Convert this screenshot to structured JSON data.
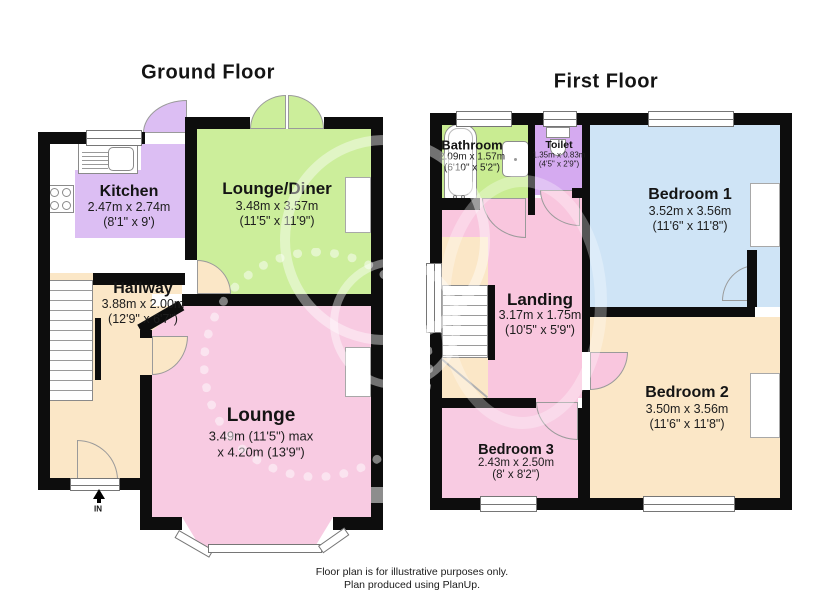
{
  "ground": {
    "title": "Ground Floor",
    "entrance_label": "IN",
    "rooms": {
      "kitchen": {
        "name": "Kitchen",
        "metric": "2.47m x 2.74m",
        "imperial": "(8'1\" x 9')"
      },
      "lounge_diner": {
        "name": "Lounge/Diner",
        "metric": "3.48m x 3.57m",
        "imperial": "(11'5\" x 11'9\")"
      },
      "hallway": {
        "name": "Hallway",
        "metric": "3.88m x 2.00m",
        "imperial": "(12'9\" x 6'7\")"
      },
      "lounge": {
        "name": "Lounge",
        "metric": "3.49m (11'5\") max",
        "imperial": "x 4.20m (13'9\")"
      }
    }
  },
  "first": {
    "title": "First Floor",
    "rooms": {
      "bathroom": {
        "name": "Bathroom",
        "metric": "2.09m x 1.57m",
        "imperial": "(6'10\" x 5'2\")"
      },
      "toilet": {
        "name": "Toilet",
        "metric": "1.35m x 0.83m",
        "imperial": "(4'5\" x 2'9\")"
      },
      "bedroom1": {
        "name": "Bedroom 1",
        "metric": "3.52m x 3.56m",
        "imperial": "(11'6\" x 11'8\")"
      },
      "landing": {
        "name": "Landing",
        "metric": "3.17m x 1.75m",
        "imperial": "(10'5\" x 5'9\")"
      },
      "bedroom2": {
        "name": "Bedroom 2",
        "metric": "3.50m x 3.56m",
        "imperial": "(11'6\" x 11'8\")"
      },
      "bedroom3": {
        "name": "Bedroom 3",
        "metric": "2.43m x 2.50m",
        "imperial": "(8' x 8'2\")"
      }
    }
  },
  "footer": {
    "line1": "Floor plan is for illustrative purposes only.",
    "line2": "Plan produced using PlanUp."
  },
  "colors": {
    "wall": "#0d0d0d",
    "kitchen": "#dcbef3",
    "lounge_diner": "#ccee9b",
    "hallway": "#fbe7c7",
    "lounge": "#f8cbe2",
    "bathroom": "#c9ec92",
    "toilet": "#d5aaf0",
    "bedroom1": "#cfe4f6",
    "landing": "#f9c6de",
    "bedroom2": "#fbe7c7",
    "bedroom3": "#f8cbe2"
  }
}
